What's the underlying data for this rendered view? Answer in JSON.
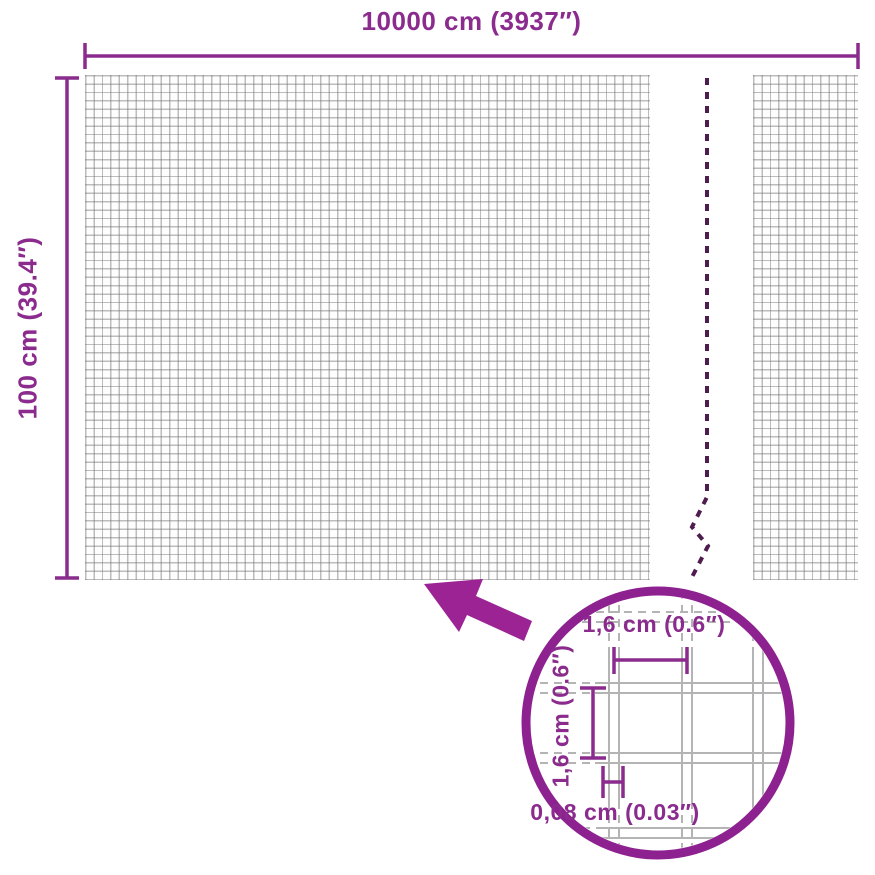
{
  "colors": {
    "accent": "#8a2b8d",
    "arrow": "#9c2394",
    "lens": "#8e2190",
    "breakline": "#4e1d4e",
    "meshline": "#b4b4b4",
    "background": "#ffffff"
  },
  "diagram": {
    "width_label": "10000 cm (3937″)",
    "height_label": "100 cm (39.4″)",
    "detail_circle": {
      "mesh_width_label": "1,6 cm (0.6″)",
      "mesh_height_label": "1,6 cm (0.6″)",
      "wire_thickness_label": "0,08 cm (0.03″)"
    }
  }
}
